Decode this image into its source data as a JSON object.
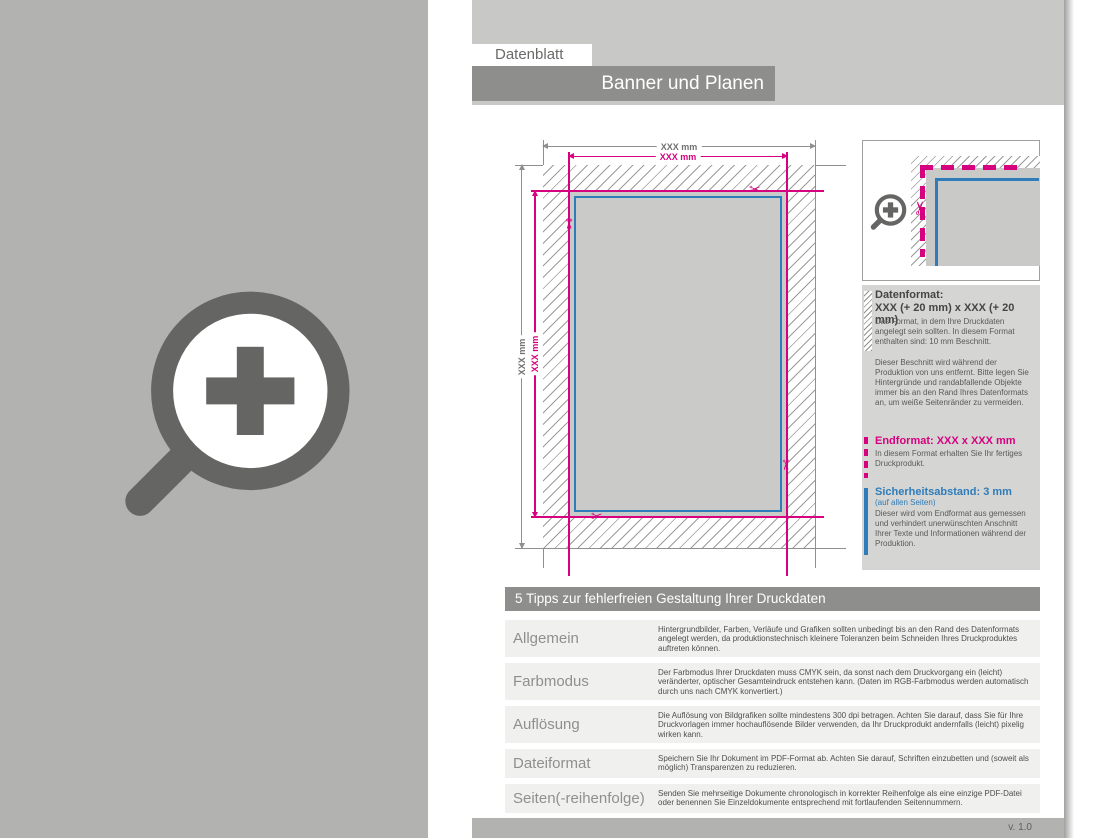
{
  "header": {
    "tab": "Datenblatt",
    "title": "Banner und Planen"
  },
  "diagram": {
    "outer_width_label": "XXX mm",
    "inner_width_label": "XXX mm",
    "outer_height_label": "XXX mm",
    "inner_height_label": "XXX mm",
    "scissors_glyph": "✂"
  },
  "info": {
    "datenformat": {
      "heading": "Datenformat:",
      "size": "XXX (+ 20 mm) x XXX (+ 20 mm)",
      "body": "Das Format, in dem Ihre Druckdaten angelegt sein sollten. In diesem Format enthalten sind: 10 mm Beschnitt.",
      "body2": "Dieser Beschnitt wird während der Produktion von uns entfernt. Bitte legen Sie Hintergründe und randabfallende Objekte immer bis an den Rand Ihres Datenformats an, um weiße Seitenränder zu vermeiden."
    },
    "endformat": {
      "heading": "Endformat: XXX x XXX mm",
      "body": "In diesem Format erhalten Sie Ihr fertiges Druckprodukt."
    },
    "sicherheitsabstand": {
      "heading": "Sicherheitsabstand: 3 mm",
      "sub": "(auf allen Seiten)",
      "body": "Dieser wird vom Endformat aus gemessen und verhindert unerwünschten Anschnitt Ihrer Texte und Informationen während der Produktion."
    }
  },
  "tips": {
    "header": "5 Tipps zur fehlerfreien Gestaltung Ihrer Druckdaten",
    "rows": [
      {
        "label": "Allgemein",
        "text": "Hintergrundbilder, Farben, Verläufe und Grafiken sollten unbedingt bis an den Rand des Datenformats angelegt werden, da produktionstechnisch kleinere Toleranzen beim Schneiden Ihres Druckproduktes auftreten können."
      },
      {
        "label": "Farbmodus",
        "text": "Der Farbmodus Ihrer Druckdaten muss CMYK sein, da sonst nach dem Druckvorgang ein (leicht) veränderter, optischer Gesamteindruck entstehen kann. (Daten im RGB-Farbmodus werden automatisch durch uns nach CMYK konvertiert.)"
      },
      {
        "label": "Auflösung",
        "text": "Die Auflösung von Bildgrafiken sollte mindestens 300 dpi betragen. Achten Sie darauf, dass Sie für Ihre Druckvorlagen immer hochauflösende Bilder verwenden, da Ihr Druckprodukt andernfalls (leicht) pixelig wirken kann."
      },
      {
        "label": "Dateiformat",
        "text": "Speichern Sie Ihr Dokument im PDF-Format ab. Achten Sie darauf, Schriften einzubetten und (soweit als möglich) Transparenzen zu reduzieren."
      },
      {
        "label": "Seiten(-reihenfolge)",
        "text": "Senden Sie mehrseitige Dokumente chronologisch in korrekter Reihenfolge als eine einzige PDF-Datei oder benennen Sie Einzeldokumente entsprechend mit fortlaufenden Seitennummern."
      }
    ]
  },
  "footer": {
    "version": "v. 1.0"
  },
  "colors": {
    "magenta": "#d6017f",
    "blue": "#2e7cba",
    "gray_dark": "#8e8e8c",
    "gray_background": "#b2b2b0"
  }
}
